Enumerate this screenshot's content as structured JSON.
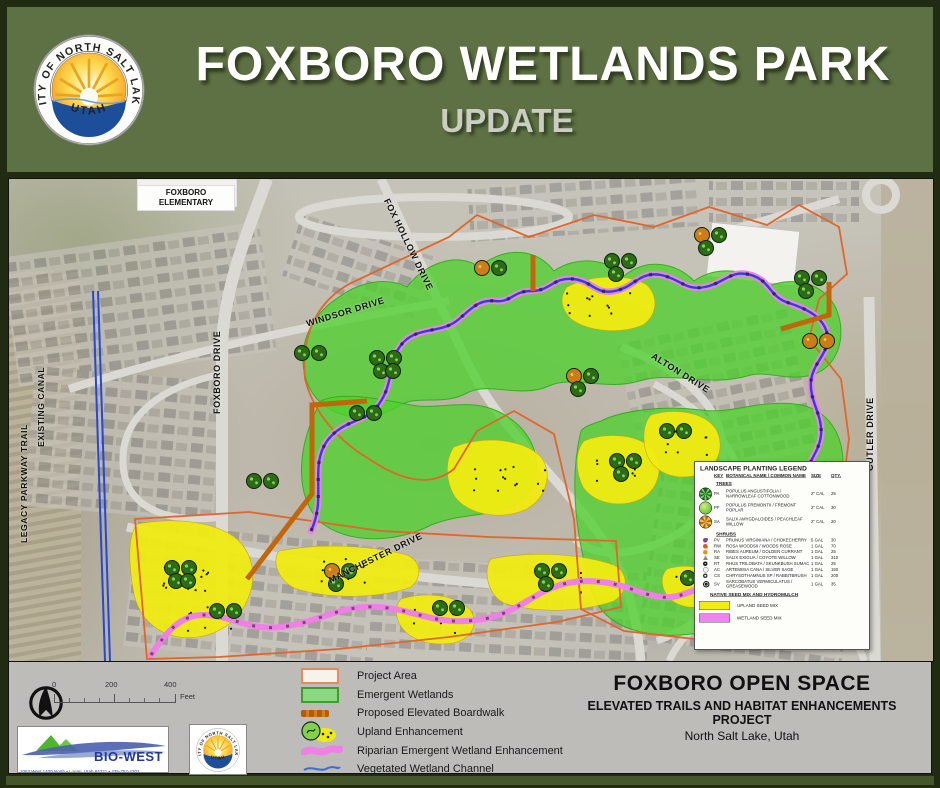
{
  "header": {
    "title": "FOXBORO WETLANDS PARK",
    "subtitle": "UPDATE"
  },
  "seal": {
    "arc_text": "CITY OF NORTH SALT LAKE",
    "bottom_text": "UTAH"
  },
  "map": {
    "school_label": "FOXBORO ELEMENTARY",
    "streets": [
      {
        "label": "FOX HOLLOW DRIVE"
      },
      {
        "label": "WINDSOR DRIVE"
      },
      {
        "label": "FOXBORO DRIVE"
      },
      {
        "label": "ALTON DRIVE"
      },
      {
        "label": "CUTLER DRIVE"
      },
      {
        "label": "MANCHESTER DRIVE"
      },
      {
        "label": "LEGACY PARKWAY TRAIL"
      },
      {
        "label": "EXISTING CANAL"
      }
    ],
    "planting_legend": {
      "title": "LANDSCAPE PLANTING LEGEND",
      "columns": {
        "key": "KEY",
        "name": "BOTANICAL NAME / COMMON NAME",
        "size": "SIZE",
        "qty": "QTY."
      },
      "trees_heading": "TREES",
      "trees": [
        {
          "key": "PA",
          "name": "POPULUS ANGUSTIFOLIA / NARROWLEAF COTTONWOOD",
          "size": "2\" CAL",
          "qty": "25"
        },
        {
          "key": "PF",
          "name": "POPULUS FREMONTII / FREMONT POPLAR",
          "size": "2\" CAL",
          "qty": "30"
        },
        {
          "key": "SA",
          "name": "SALIX AMYGDALOIDES / PEACHLEAF WILLOW",
          "size": "2\" CAL",
          "qty": "20"
        }
      ],
      "shrubs_heading": "SHRUBS",
      "shrubs": [
        {
          "key": "PV",
          "name": "PRUNUS VIRGINIANA / CHOKECHERRY",
          "size": "5 GAL",
          "qty": "30"
        },
        {
          "key": "RW",
          "name": "ROSA WOODSII / WOODS ROSE",
          "size": "1 GAL",
          "qty": "70"
        },
        {
          "key": "RA",
          "name": "RIBES AUREUM / GOLDEN CURRANT",
          "size": "1 GAL",
          "qty": "25"
        },
        {
          "key": "SE",
          "name": "SALIX EXIGUA / COYOTE WILLOW",
          "size": "1 GAL",
          "qty": "310"
        },
        {
          "key": "RT",
          "name": "RHUS TRILOBATA / SKUNKBUSH SUMAC",
          "size": "1 GAL",
          "qty": "25"
        },
        {
          "key": "AC",
          "name": "ARTEMISIA CANA / SILVER SAGE",
          "size": "1 GAL",
          "qty": "150"
        },
        {
          "key": "CS",
          "name": "CHRYSOTHAMNUS SP / RABBITBRUSH",
          "size": "1 GAL",
          "qty": "200"
        },
        {
          "key": "SV",
          "name": "SARCOBATUS VERMICULATUS / GREASEWOOD",
          "size": "1 GAL",
          "qty": "35"
        }
      ],
      "seed_heading": "NATIVE SEED MIX AND HYDROMULCH",
      "seed": [
        {
          "label": "UPLAND SEED MIX",
          "color": "#f0eb12"
        },
        {
          "label": "WETLAND SEED MIX",
          "color": "#f083ef"
        }
      ]
    }
  },
  "footer": {
    "scale": {
      "t0": "0",
      "t200": "200",
      "t400": "400",
      "unit": "Feet"
    },
    "legend": [
      {
        "label": "Project Area"
      },
      {
        "label": "Emergent Wetlands"
      },
      {
        "label": "Proposed Elevated Boardwalk"
      },
      {
        "label": "Upland Enhancement"
      },
      {
        "label": "Riparian Emergent Wetland Enhancement"
      },
      {
        "label": "Vegetated Wetland Channel"
      }
    ],
    "title_block": {
      "title": "FOXBORO OPEN SPACE",
      "line2": "ELEVATED TRAILS AND HABITAT ENHANCEMENTS",
      "line3": "PROJECT",
      "line4": "North Salt Lake, Utah"
    },
    "biowest": {
      "name": "BIO-WEST",
      "address": "1063 West 1400 North • Logan, Utah 84321 • 435-752-4202"
    }
  },
  "colors": {
    "banner_green": "#5e7144",
    "frame_green": "#202b12",
    "bottom_strip_green": "#44562a",
    "wetland_green": "#4fd02e",
    "upland_yellow": "#f0eb12",
    "riparian_pink": "#f07fe6",
    "channel_blue": "#2944d2",
    "boundary_orange": "#e0662a",
    "boardwalk_orange": "#c2660a"
  }
}
